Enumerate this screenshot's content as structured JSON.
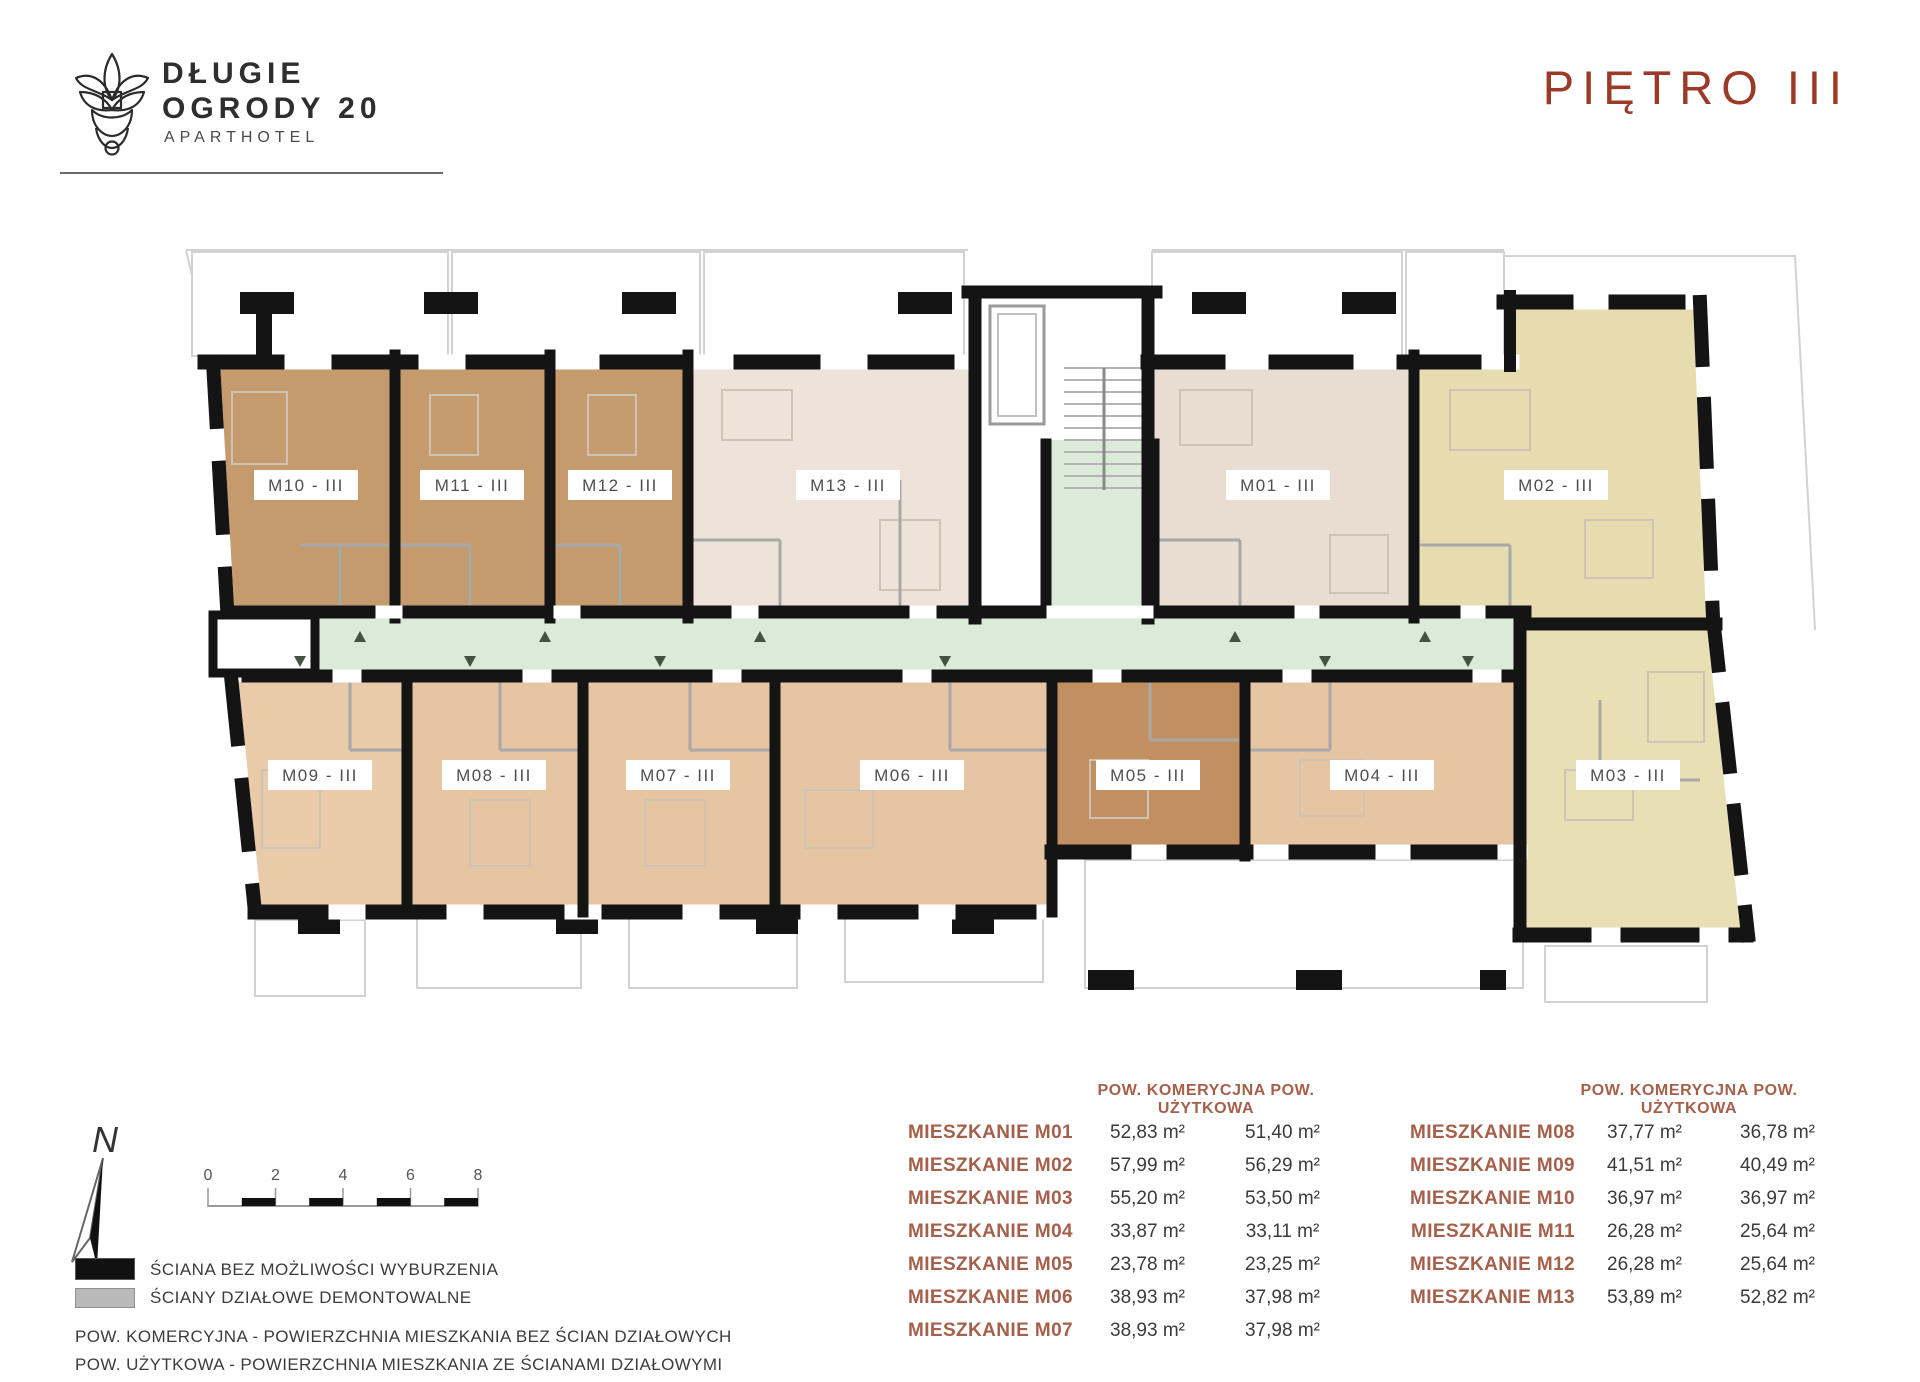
{
  "brand": {
    "line1": "DŁUGIE",
    "line2": "OGRODY 20",
    "line3": "APARTHOTEL"
  },
  "page_title": "PIĘTRO  III",
  "floor_plan": {
    "corridor_color": "#dcead9",
    "units": [
      {
        "id": "M10",
        "label": "M10 - III",
        "color": "#c59b6e"
      },
      {
        "id": "M11",
        "label": "M11 - III",
        "color": "#c59b6e"
      },
      {
        "id": "M12",
        "label": "M12 - III",
        "color": "#c59b6e"
      },
      {
        "id": "M13",
        "label": "M13 - III",
        "color": "#eee3d8"
      },
      {
        "id": "M01",
        "label": "M01 - III",
        "color": "#e9ddd1"
      },
      {
        "id": "M02",
        "label": "M02 - III",
        "color": "#e7dcb0"
      },
      {
        "id": "M09",
        "label": "M09 - III",
        "color": "#e9cba9"
      },
      {
        "id": "M08",
        "label": "M08 - III",
        "color": "#e6c5a3"
      },
      {
        "id": "M07",
        "label": "M07 - III",
        "color": "#e6c5a3"
      },
      {
        "id": "M06",
        "label": "M06 - III",
        "color": "#e6c5a3"
      },
      {
        "id": "M05",
        "label": "M05 - III",
        "color": "#c28f60"
      },
      {
        "id": "M04",
        "label": "M04 - III",
        "color": "#e6c5a3"
      },
      {
        "id": "M03",
        "label": "M03 - III",
        "color": "#e8dfb5"
      }
    ]
  },
  "compass": {
    "north_label": "N"
  },
  "scale_bar": {
    "ticks": [
      "0",
      "2",
      "4",
      "6",
      "8"
    ]
  },
  "legend": {
    "items": [
      {
        "swatch_color": "#111111",
        "label": "ŚCIANA BEZ MOŻLIWOŚCI WYBURZENIA"
      },
      {
        "swatch_color": "#b9b9b9",
        "label": "ŚCIANY DZIAŁOWE DEMONTOWALNE"
      }
    ],
    "definitions": [
      "POW. KOMERCYJNA  -  POWIERZCHNIA MIESZKANIA BEZ ŚCIAN DZIAŁOWYCH",
      "POW. UŻYTKOWA  -  POWIERZCHNIA MIESZKANIA ZE ŚCIANAMI DZIAŁOWYMI"
    ]
  },
  "tables": {
    "header_left": "POW. KOMERYCJNA POW. UŻYTKOWA",
    "header_right": "POW. KOMERYCJNA POW. UŻYTKOWA",
    "left": {
      "rows": [
        {
          "label": "MIESZKANIE M01",
          "komercyjna": "52,83 m²",
          "uzytkowa": "51,40 m²"
        },
        {
          "label": "MIESZKANIE M02",
          "komercyjna": "57,99 m²",
          "uzytkowa": "56,29 m²"
        },
        {
          "label": "MIESZKANIE M03",
          "komercyjna": "55,20 m²",
          "uzytkowa": "53,50 m²"
        },
        {
          "label": "MIESZKANIE M04",
          "komercyjna": "33,87 m²",
          "uzytkowa": "33,11 m²"
        },
        {
          "label": "MIESZKANIE M05",
          "komercyjna": "23,78 m²",
          "uzytkowa": "23,25 m²"
        },
        {
          "label": "MIESZKANIE M06",
          "komercyjna": "38,93 m²",
          "uzytkowa": "37,98 m²"
        },
        {
          "label": "MIESZKANIE M07",
          "komercyjna": "38,93 m²",
          "uzytkowa": "37,98 m²"
        }
      ]
    },
    "right": {
      "rows": [
        {
          "label": "MIESZKANIE M08",
          "komercyjna": "37,77 m²",
          "uzytkowa": "36,78 m²"
        },
        {
          "label": "MIESZKANIE M09",
          "komercyjna": "41,51 m²",
          "uzytkowa": "40,49 m²"
        },
        {
          "label": "MIESZKANIE M10",
          "komercyjna": "36,97 m²",
          "uzytkowa": "36,97 m²"
        },
        {
          "label": "MIESZKANIE M11",
          "komercyjna": "26,28 m²",
          "uzytkowa": "25,64 m²"
        },
        {
          "label": "MIESZKANIE M12",
          "komercyjna": "26,28 m²",
          "uzytkowa": "25,64 m²"
        },
        {
          "label": "MIESZKANIE M13",
          "komercyjna": "53,89 m²",
          "uzytkowa": "52,82 m²"
        }
      ]
    }
  }
}
